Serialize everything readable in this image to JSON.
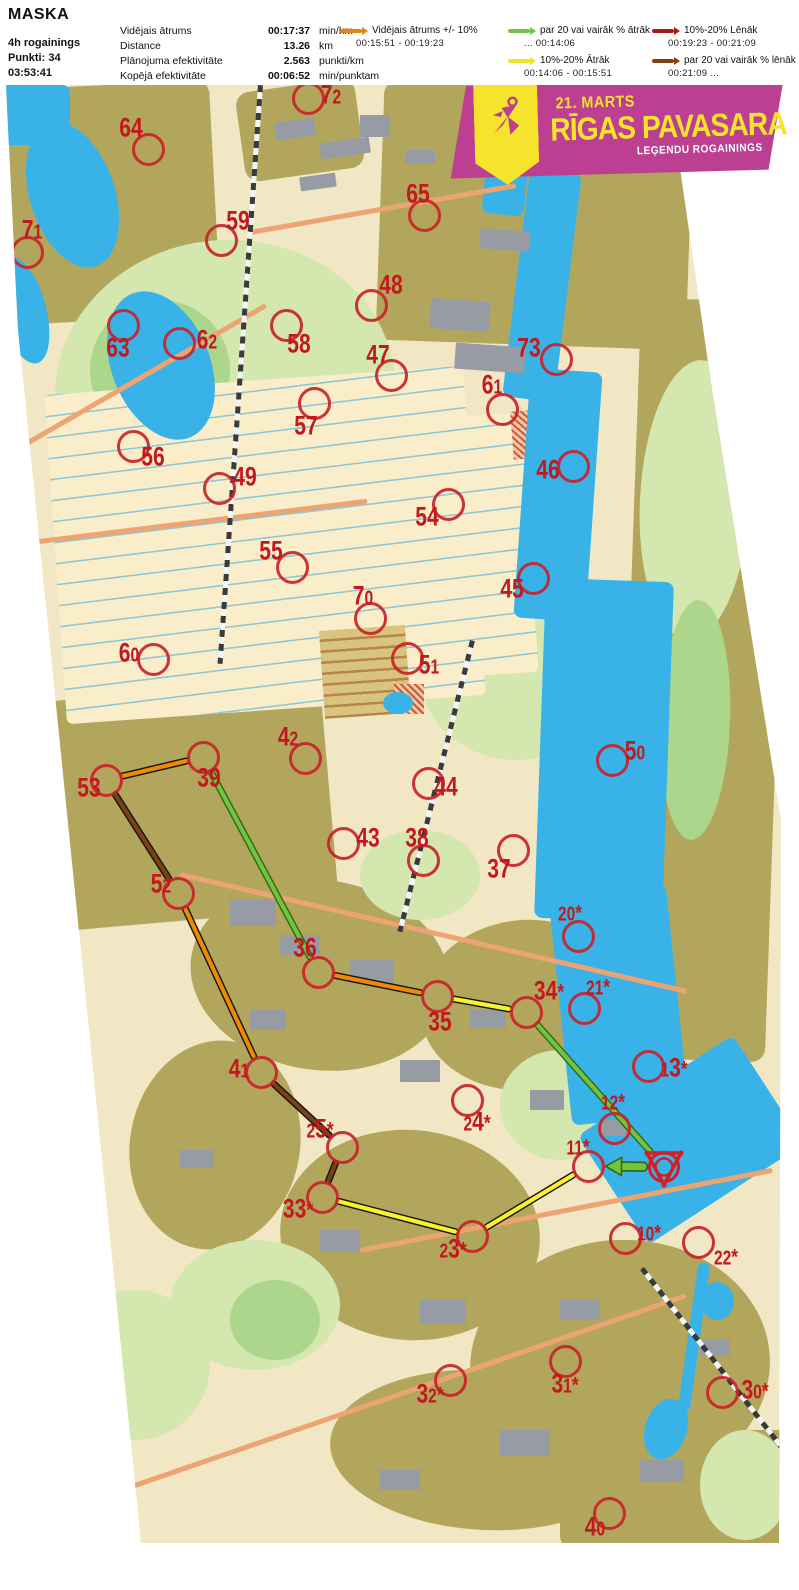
{
  "header": {
    "title": "MASKA",
    "info": [
      "4h rogainings",
      "Punkti: 34",
      "03:53:41"
    ],
    "stats": [
      {
        "label": "Vidējais ātrums",
        "value": "00:17:37",
        "unit": "min/km"
      },
      {
        "label": "Distance",
        "value": "13.26",
        "unit": "km"
      },
      {
        "label": "Plānojuma efektivitāte",
        "value": "2.563",
        "unit": "punkti/km"
      },
      {
        "label": "Kopējā efektivitāte",
        "value": "00:06:52",
        "unit": "min/punktam"
      }
    ],
    "legend": [
      {
        "key": "avg",
        "color": "#E8820C",
        "label": "Vidējais ātrums +/- 10%",
        "range": "00:15:51  -  00:19:23"
      },
      {
        "key": "fast20",
        "color": "#74C244",
        "label": "par 20 vai vairāk % ātrāk",
        "range": "...   00:14:06"
      },
      {
        "key": "fast10",
        "color": "#F0E32A",
        "label": "10%-20% Ātrāk",
        "range": "00:14:06  -  00:15:51"
      },
      {
        "key": "slow10",
        "color": "#A61C19",
        "label": "10%-20% Lēnāk",
        "range": "00:19:23  -  00:21:09"
      },
      {
        "key": "slow20",
        "color": "#7E4012",
        "label": "par 20 vai vairāk % lēnāk",
        "range": "00:21:09  ..."
      }
    ]
  },
  "banner": {
    "date": "21. MARTS",
    "title": "RĪGAS PAVASARA",
    "subtitle": "LEĢENDU ROGAININGS"
  },
  "map": {
    "colors": {
      "avg": "#EF8A00",
      "fast20": "#74C244",
      "fast10": "#F7F22C",
      "slow10": "#A61C19",
      "slow20": "#7E4012",
      "casing": "#141414",
      "green_casing": "#2F6B10",
      "control": "#C8232B"
    },
    "start": {
      "x": 664,
      "y": 1167
    },
    "controls": [
      {
        "id": "72",
        "cx": 308,
        "cy": 98,
        "lx": 331,
        "ly": 95
      },
      {
        "id": "64",
        "cx": 148,
        "cy": 149,
        "lx": 131,
        "ly": 128
      },
      {
        "id": "65",
        "cx": 424,
        "cy": 215,
        "lx": 418,
        "ly": 194
      },
      {
        "id": "71",
        "cx": 27,
        "cy": 252,
        "lx": 32,
        "ly": 230
      },
      {
        "id": "59",
        "cx": 221,
        "cy": 240,
        "lx": 238,
        "ly": 221
      },
      {
        "id": "48",
        "cx": 371,
        "cy": 305,
        "lx": 391,
        "ly": 285
      },
      {
        "id": "63",
        "cx": 123,
        "cy": 325,
        "lx": 118,
        "ly": 348
      },
      {
        "id": "62",
        "cx": 179,
        "cy": 343,
        "lx": 207,
        "ly": 340
      },
      {
        "id": "58",
        "cx": 286,
        "cy": 325,
        "lx": 299,
        "ly": 344
      },
      {
        "id": "47",
        "cx": 391,
        "cy": 375,
        "lx": 378,
        "ly": 355
      },
      {
        "id": "73",
        "cx": 556,
        "cy": 359,
        "lx": 529,
        "ly": 348
      },
      {
        "id": "61",
        "cx": 502,
        "cy": 409,
        "lx": 492,
        "ly": 385
      },
      {
        "id": "57",
        "cx": 314,
        "cy": 403,
        "lx": 306,
        "ly": 426
      },
      {
        "id": "56",
        "cx": 133,
        "cy": 446,
        "lx": 153,
        "ly": 457
      },
      {
        "id": "46",
        "cx": 573,
        "cy": 466,
        "lx": 548,
        "ly": 470
      },
      {
        "id": "49",
        "cx": 219,
        "cy": 488,
        "lx": 245,
        "ly": 477
      },
      {
        "id": "54",
        "cx": 448,
        "cy": 504,
        "lx": 427,
        "ly": 517
      },
      {
        "id": "55",
        "cx": 292,
        "cy": 567,
        "lx": 271,
        "ly": 551
      },
      {
        "id": "45",
        "cx": 533,
        "cy": 578,
        "lx": 512,
        "ly": 589
      },
      {
        "id": "70",
        "cx": 370,
        "cy": 618,
        "lx": 363,
        "ly": 596
      },
      {
        "id": "60",
        "cx": 153,
        "cy": 659,
        "lx": 129,
        "ly": 653
      },
      {
        "id": "51",
        "cx": 407,
        "cy": 658,
        "lx": 429,
        "ly": 665
      },
      {
        "id": "50",
        "cx": 612,
        "cy": 760,
        "lx": 635,
        "ly": 751
      },
      {
        "id": "42",
        "cx": 305,
        "cy": 758,
        "lx": 288,
        "ly": 737
      },
      {
        "id": "39",
        "cx": 203,
        "cy": 757,
        "lx": 209,
        "ly": 778
      },
      {
        "id": "53",
        "cx": 106,
        "cy": 780,
        "lx": 89,
        "ly": 788
      },
      {
        "id": "44",
        "cx": 428,
        "cy": 783,
        "lx": 446,
        "ly": 787
      },
      {
        "id": "43",
        "cx": 343,
        "cy": 843,
        "lx": 368,
        "ly": 838
      },
      {
        "id": "38",
        "cx": 423,
        "cy": 860,
        "lx": 417,
        "ly": 838
      },
      {
        "id": "37",
        "cx": 513,
        "cy": 850,
        "lx": 499,
        "ly": 869
      },
      {
        "id": "52",
        "cx": 178,
        "cy": 893,
        "lx": 161,
        "ly": 884
      },
      {
        "id": "20*",
        "cx": 578,
        "cy": 936,
        "lx": 570,
        "ly": 912
      },
      {
        "id": "36",
        "cx": 318,
        "cy": 972,
        "lx": 305,
        "ly": 948
      },
      {
        "id": "34*",
        "cx": 526,
        "cy": 1012,
        "lx": 549,
        "ly": 991
      },
      {
        "id": "21*",
        "cx": 584,
        "cy": 1008,
        "lx": 598,
        "ly": 986
      },
      {
        "id": "35",
        "cx": 437,
        "cy": 996,
        "lx": 440,
        "ly": 1022
      },
      {
        "id": "13*",
        "cx": 648,
        "cy": 1066,
        "lx": 674,
        "ly": 1068
      },
      {
        "id": "41",
        "cx": 261,
        "cy": 1072,
        "lx": 239,
        "ly": 1069
      },
      {
        "id": "24*",
        "cx": 467,
        "cy": 1100,
        "lx": 477,
        "ly": 1122
      },
      {
        "id": "12*",
        "cx": 614,
        "cy": 1128,
        "lx": 613,
        "ly": 1101
      },
      {
        "id": "25*",
        "cx": 342,
        "cy": 1147,
        "lx": 320,
        "ly": 1129
      },
      {
        "id": "11*",
        "cx": 588,
        "cy": 1166,
        "lx": 578,
        "ly": 1146
      },
      {
        "id": "33*",
        "cx": 322,
        "cy": 1197,
        "lx": 298,
        "ly": 1209
      },
      {
        "id": "23*",
        "cx": 472,
        "cy": 1236,
        "lx": 453,
        "ly": 1249
      },
      {
        "id": "10*",
        "cx": 625,
        "cy": 1238,
        "lx": 649,
        "ly": 1232
      },
      {
        "id": "22*",
        "cx": 698,
        "cy": 1242,
        "lx": 726,
        "ly": 1256
      },
      {
        "id": "32*",
        "cx": 450,
        "cy": 1380,
        "lx": 430,
        "ly": 1394
      },
      {
        "id": "31*",
        "cx": 565,
        "cy": 1361,
        "lx": 565,
        "ly": 1384
      },
      {
        "id": "30*",
        "cx": 722,
        "cy": 1392,
        "lx": 755,
        "ly": 1390
      },
      {
        "id": "40",
        "cx": 609,
        "cy": 1513,
        "lx": 595,
        "ly": 1527
      }
    ],
    "route_legs": [
      {
        "from": "11*",
        "to": "23*",
        "speed": "fast10"
      },
      {
        "from": "23*",
        "to": "33*",
        "speed": "fast10"
      },
      {
        "from": "33*",
        "to": "25*",
        "speed": "slow20"
      },
      {
        "from": "25*",
        "to": "41",
        "speed": "slow20"
      },
      {
        "from": "41",
        "to": "52",
        "speed": "avg"
      },
      {
        "from": "52",
        "to": "53",
        "speed": "slow20"
      },
      {
        "from": "53",
        "to": "39",
        "speed": "avg"
      },
      {
        "from": "39",
        "to": "36",
        "speed": "fast20"
      },
      {
        "from": "36",
        "to": "35",
        "speed": "avg"
      },
      {
        "from": "35",
        "to": "34*",
        "speed": "fast10"
      },
      {
        "from": "34*",
        "to": "start",
        "speed": "fast20"
      },
      {
        "from": "start",
        "to": "11*",
        "speed": "fast20",
        "arrow": true
      }
    ]
  }
}
